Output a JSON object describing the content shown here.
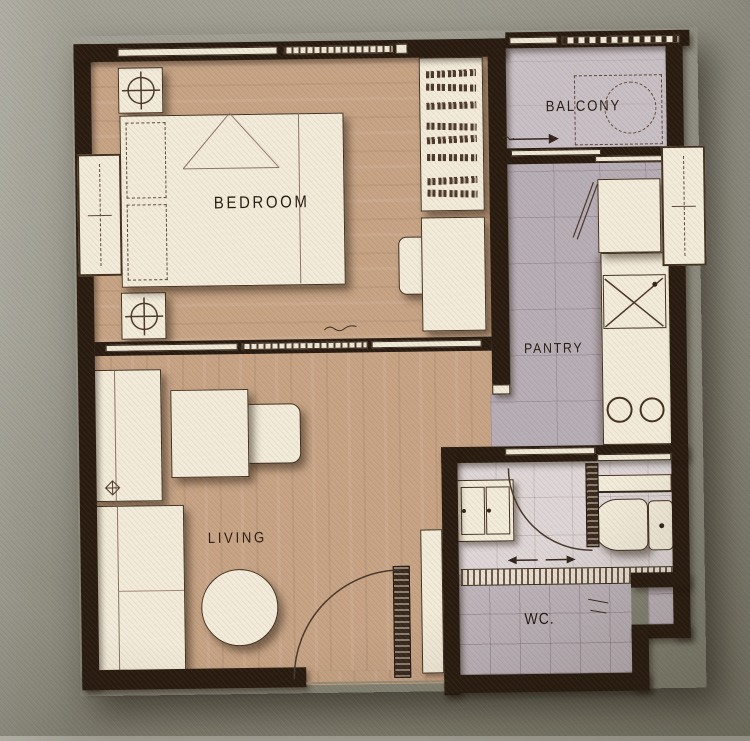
{
  "floor_plan": {
    "rooms": [
      {
        "id": "bedroom",
        "label": "BEDROOM"
      },
      {
        "id": "balcony",
        "label": "BALCONY"
      },
      {
        "id": "pantry",
        "label": "PANTRY"
      },
      {
        "id": "living",
        "label": "LIVING"
      },
      {
        "id": "wc",
        "label": "WC."
      }
    ],
    "colors": {
      "background": "#8d8b7f",
      "wall": "#281a0e",
      "wood_floor": "#c7a384",
      "pantry_tile_floor": "#b7adb5",
      "balcony_floor": "#c8bfc5",
      "wc_floor": "#ded6d6",
      "shower_floor": "#bdb3b9",
      "furniture": "#f3ebd9",
      "label_text": "#261b10"
    }
  }
}
